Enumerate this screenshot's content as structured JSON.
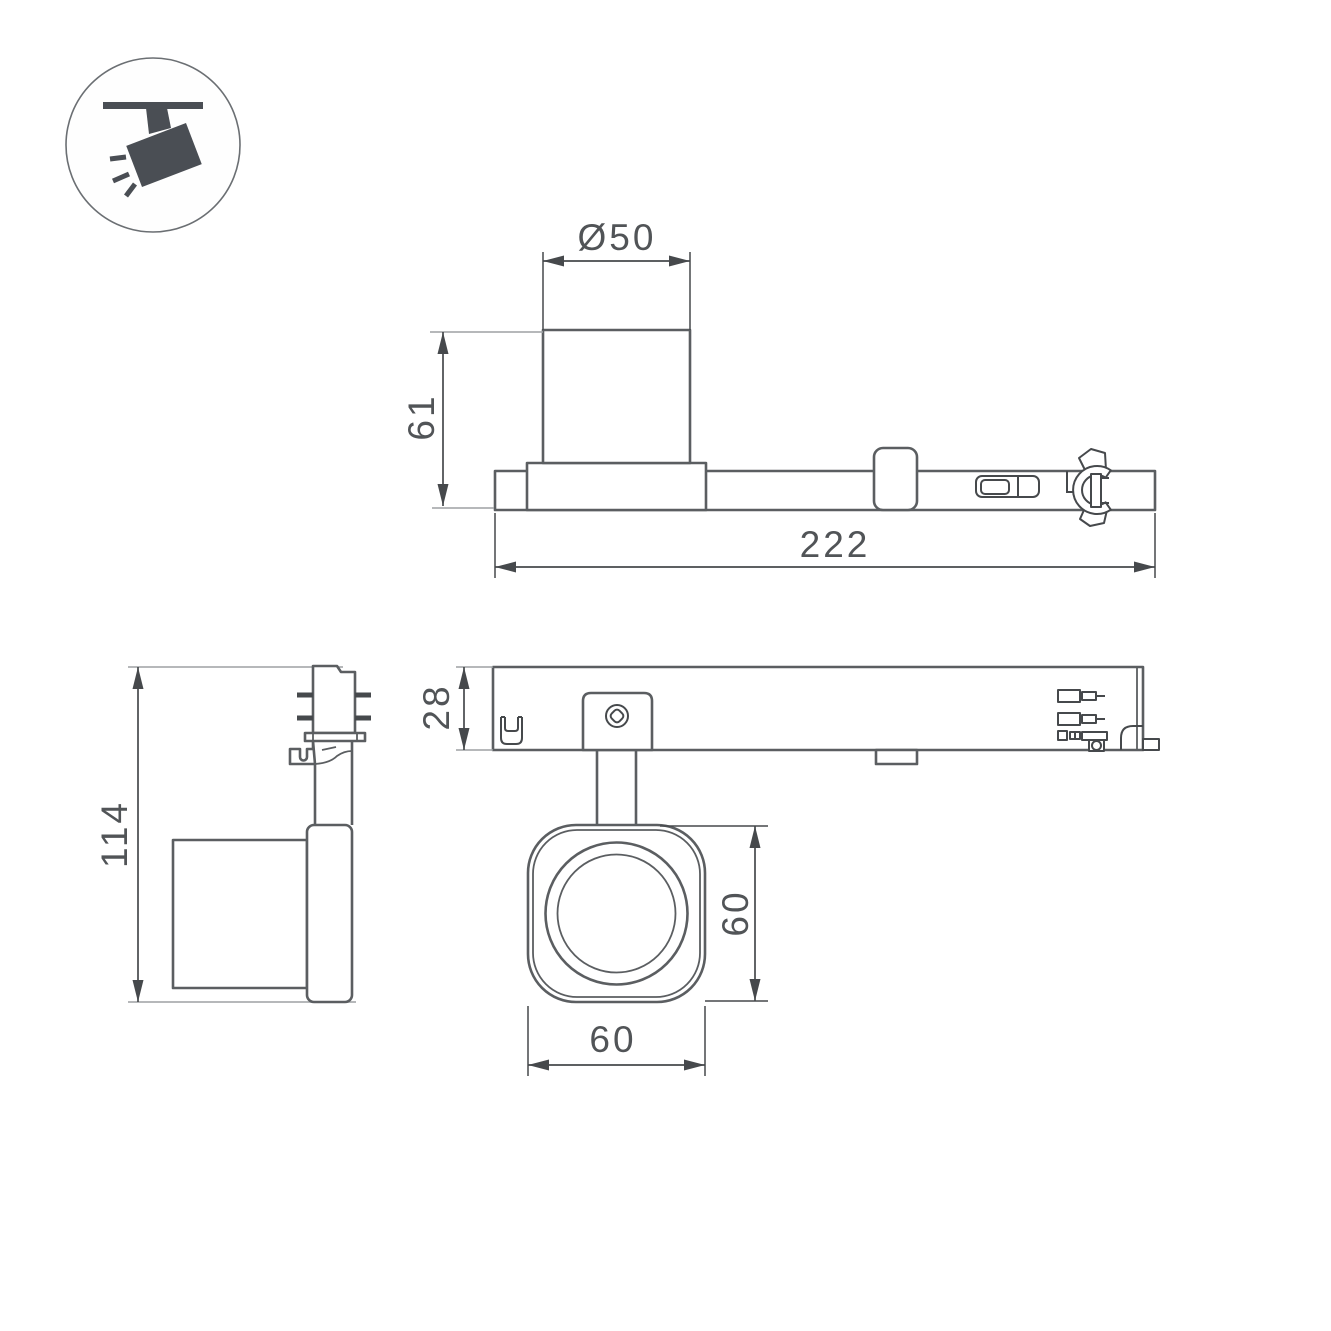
{
  "icon": {
    "name": "track-spotlight-icon"
  },
  "colors": {
    "background": "#ffffff",
    "outline": "#5b5e61",
    "dimension": "#46494c",
    "extension_light": "#9da1a4",
    "text": "#515457",
    "icon_fill": "#4a4e54"
  },
  "side_view": {
    "diameter_label": "Ø50",
    "height_label": "61",
    "length_label": "222"
  },
  "front_view": {
    "height_label": "114"
  },
  "plan_view": {
    "depth_label": "28",
    "head_height_label": "60",
    "head_width_label": "60"
  }
}
